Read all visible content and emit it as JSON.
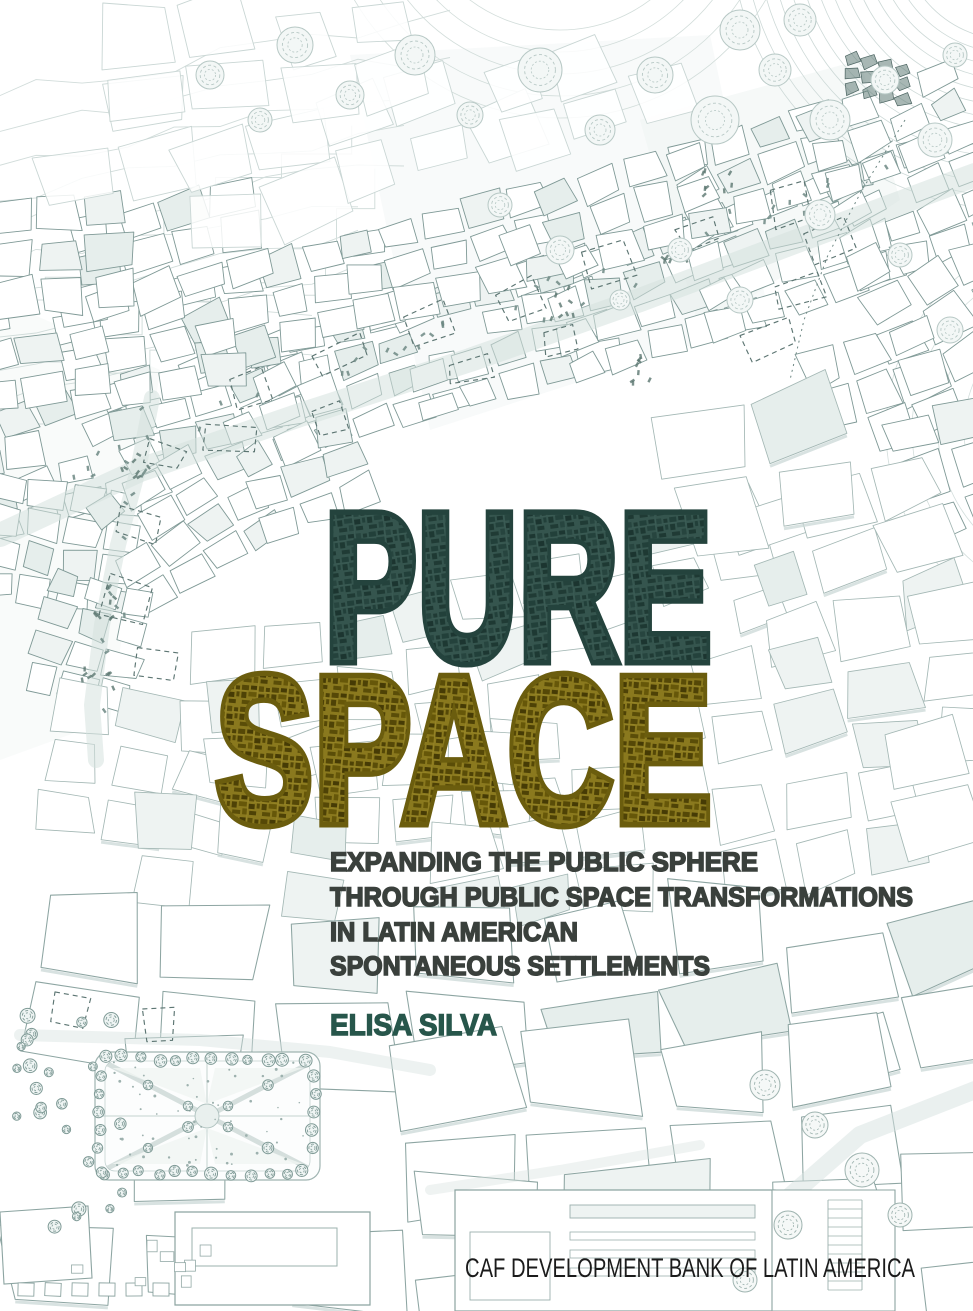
{
  "cover": {
    "title_line1": "PURE",
    "title_line2": "SPACE",
    "subtitle_lines": [
      "EXPANDING THE PUBLIC SPHERE",
      "THROUGH PUBLIC SPACE TRANSFORMATIONS",
      "IN LATIN AMERICAN",
      "SPONTANEOUS SETTLEMENTS"
    ],
    "author": "ELISA SILVA",
    "publisher": "CAF DEVELOPMENT BANK OF LATIN AMERICA",
    "colors": {
      "title_teal": "#2E4B45",
      "title_olive": "#77670F",
      "subtitle_ink": "#3A403C",
      "author_teal": "#27564B",
      "publisher_ink": "#1B1B1B",
      "drawing_line": "#8FA7A4",
      "drawing_wash": "#E3EBE9"
    }
  }
}
